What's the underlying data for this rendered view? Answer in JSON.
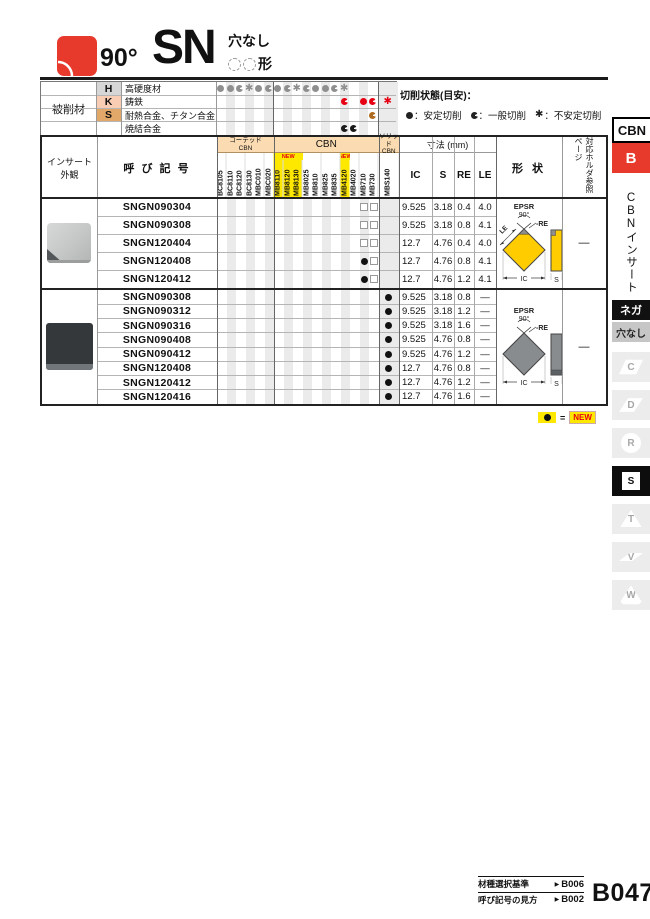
{
  "header": {
    "angle": "90°",
    "series": "SN",
    "hole_label": "穴なし",
    "shape_suffix": "形"
  },
  "colors": {
    "accent_red": "#e8392d",
    "new_yellow": "#ffe800",
    "new_text": "#e60012",
    "header_peach": "#fbdcb2",
    "stripe": "#ebebeb",
    "insert_yellow": "#ffcc00",
    "insert_gray": "#888c8f",
    "legend_symbol": "#222222"
  },
  "workpiece": {
    "label": "被削材",
    "rows": [
      {
        "code": "H",
        "name": "高硬度材",
        "color": "#8f8f8f",
        "bg": "#d6d6d6",
        "marks": {
          "BC8105": "full",
          "BC8110": "full",
          "BC8120": "general",
          "BC8130": "unstable",
          "MBC010": "full",
          "MBC020": "general",
          "MB8110": "full",
          "MB8120": "general",
          "MB8130": "unstable",
          "MB8025": "general",
          "MB810": "full",
          "MB825": "full",
          "MB835": "general",
          "MB4120": "unstable"
        }
      },
      {
        "code": "K",
        "name": "鋳鉄",
        "color": "#e60012",
        "bg": "#f9cdb4",
        "marks": {
          "MB4120": "general",
          "MB710": "full",
          "MB730": "general",
          "MBS140": "unstable"
        }
      },
      {
        "code": "S",
        "name": "耐熱合金、チタン合金",
        "color": "#b06a1f",
        "bg": "#e2a86a",
        "marks": {
          "MB730": "general"
        }
      },
      {
        "code": "",
        "name": "焼結合金",
        "color": "#1a1a1a",
        "bg": "#ffffff",
        "marks": {
          "MB4120": "general",
          "MB4020": "general"
        }
      }
    ]
  },
  "cutting_legend": {
    "title": "切削状態(目安)：",
    "items": [
      {
        "symbol": "full",
        "label": "：安定切削"
      },
      {
        "symbol": "general",
        "label": "：一般切削"
      },
      {
        "symbol": "unstable",
        "label": "：不安定切削"
      }
    ]
  },
  "grade_columns": {
    "groups": [
      {
        "name": "コーテッド\nCBN",
        "cols": [
          "BC8105",
          "BC8110",
          "BC8120",
          "BC8130",
          "MBC010",
          "MBC020"
        ]
      },
      {
        "name": "CBN",
        "cols": [
          "MB8110",
          "MB8120",
          "MB8130",
          "MB8025",
          "MB810",
          "MB825",
          "MB835",
          "MB4120",
          "MB4020",
          "MB710",
          "MB730"
        ]
      },
      {
        "name": "ソリッド\nCBN",
        "cols": [
          "MBS140"
        ]
      }
    ],
    "new_cols": [
      "MB8110",
      "MB8120",
      "MB8130",
      "MB4120"
    ],
    "new_tag": "NEW"
  },
  "table": {
    "headers": {
      "appearance": "インサート外観",
      "designation": "呼 び 記 号",
      "dimensions": "寸法 (mm)",
      "ic": "IC",
      "s": "S",
      "re": "RE",
      "le": "LE",
      "shape": "形 状",
      "holder": "対応ホルダ参照ページ"
    },
    "groups": [
      {
        "holder_ref": "—",
        "insert_style": "tipped",
        "rows": [
          {
            "designation": "SNGN090304",
            "marks": {
              "MB710": "square",
              "MB730": "square"
            },
            "ic": "9.525",
            "s": "3.18",
            "re": "0.4",
            "le": "4.0"
          },
          {
            "designation": "SNGN090308",
            "marks": {
              "MB710": "square",
              "MB730": "square"
            },
            "ic": "9.525",
            "s": "3.18",
            "re": "0.8",
            "le": "4.1"
          },
          {
            "designation": "SNGN120404",
            "marks": {
              "MB710": "square",
              "MB730": "square"
            },
            "ic": "12.7",
            "s": "4.76",
            "re": "0.4",
            "le": "4.0"
          },
          {
            "designation": "SNGN120408",
            "marks": {
              "MB710": "full",
              "MB730": "square"
            },
            "ic": "12.7",
            "s": "4.76",
            "re": "0.8",
            "le": "4.1"
          },
          {
            "designation": "SNGN120412",
            "marks": {
              "MB710": "full",
              "MB730": "square"
            },
            "ic": "12.7",
            "s": "4.76",
            "re": "1.2",
            "le": "4.1"
          }
        ]
      },
      {
        "holder_ref": "—",
        "insert_style": "solid",
        "rows": [
          {
            "designation": "SNGN090308",
            "marks": {
              "MBS140": "full"
            },
            "ic": "9.525",
            "s": "3.18",
            "re": "0.8",
            "le": "—"
          },
          {
            "designation": "SNGN090312",
            "marks": {
              "MBS140": "full"
            },
            "ic": "9.525",
            "s": "3.18",
            "re": "1.2",
            "le": "—"
          },
          {
            "designation": "SNGN090316",
            "marks": {
              "MBS140": "full"
            },
            "ic": "9.525",
            "s": "3.18",
            "re": "1.6",
            "le": "—"
          },
          {
            "designation": "SNGN090408",
            "marks": {
              "MBS140": "full"
            },
            "ic": "9.525",
            "s": "4.76",
            "re": "0.8",
            "le": "—"
          },
          {
            "designation": "SNGN090412",
            "marks": {
              "MBS140": "full"
            },
            "ic": "9.525",
            "s": "4.76",
            "re": "1.2",
            "le": "—"
          },
          {
            "designation": "SNGN120408",
            "marks": {
              "MBS140": "full"
            },
            "ic": "12.7",
            "s": "4.76",
            "re": "0.8",
            "le": "—"
          },
          {
            "designation": "SNGN120412",
            "marks": {
              "MBS140": "full"
            },
            "ic": "12.7",
            "s": "4.76",
            "re": "1.2",
            "le": "—"
          },
          {
            "designation": "SNGN120416",
            "marks": {
              "MBS140": "full"
            },
            "ic": "12.7",
            "s": "4.76",
            "re": "1.6",
            "le": "—"
          }
        ]
      }
    ]
  },
  "shape_diagram": {
    "epsr": "EPSR",
    "angle": "90°",
    "re": "-RE",
    "le": "LE",
    "ic": "IC",
    "s": "S"
  },
  "new_legend": {
    "symbol": "full",
    "equals": "=",
    "label": "NEW"
  },
  "footer": {
    "links": [
      {
        "label": "材種選択基準",
        "page": "B006"
      },
      {
        "label": "呼び記号の見方",
        "page": "B002"
      }
    ],
    "page_number": "B047"
  },
  "sidebar": {
    "tab": "CBN",
    "section_letter": "B",
    "section_label": "CBNインサート",
    "nega_label": "ネガ",
    "hole_label": "穴なし",
    "shapes": [
      {
        "letter": "C",
        "shape": "parallelogram-80",
        "active": false
      },
      {
        "letter": "D",
        "shape": "diamond-55",
        "active": false
      },
      {
        "letter": "R",
        "shape": "round",
        "active": false
      },
      {
        "letter": "S",
        "shape": "square",
        "active": true
      },
      {
        "letter": "T",
        "shape": "triangle",
        "active": false
      },
      {
        "letter": "V",
        "shape": "diamond-35",
        "active": false
      },
      {
        "letter": "W",
        "shape": "trigon",
        "active": false
      }
    ]
  }
}
